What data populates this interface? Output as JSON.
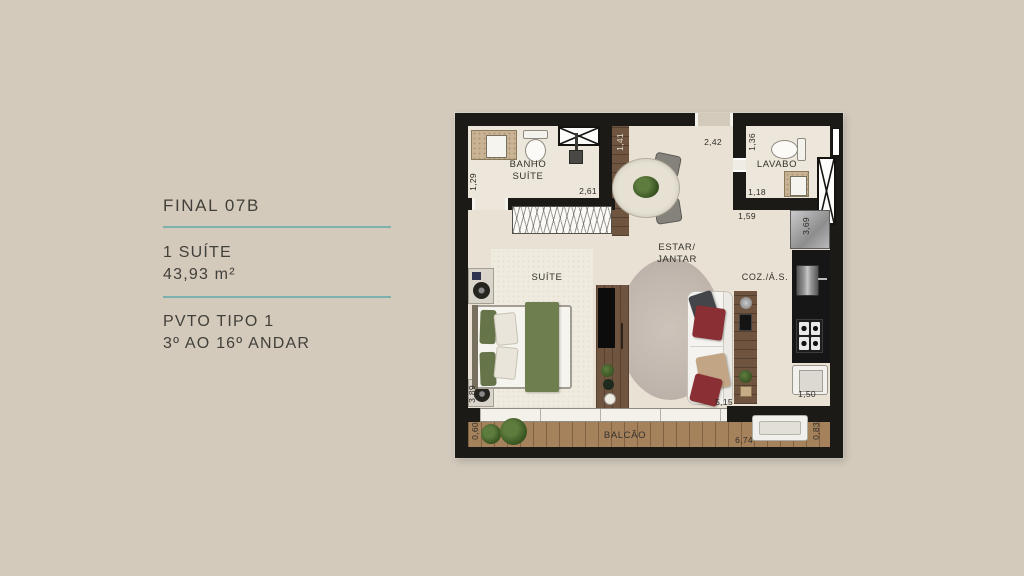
{
  "canvas": {
    "background": "#d3cabc"
  },
  "info_panel": {
    "title": "FINAL 07B",
    "unit_line1": "1 SUÍTE",
    "unit_line2": "43,93 m²",
    "pvto_line1": "PVTO TIPO 1",
    "pvto_line2": "3º AO 16º ANDAR",
    "divider_color": "#7db1ad",
    "text_color": "#42403a"
  },
  "plan": {
    "rooms": {
      "banho_line1": "BANHO",
      "banho_line2": "SUÍTE",
      "lavabo": "LAVABO",
      "estar_line1": "ESTAR/",
      "estar_line2": "JANTAR",
      "suite": "SUÍTE",
      "cozinha": "COZ./Á.S.",
      "balcao": "BALCÃO"
    },
    "dimensions": {
      "banho_width": "1,29",
      "banho_length": "2,61",
      "hall_depth": "1,41",
      "hall_width": "2,42",
      "lavabo_width": "1,36",
      "lavabo_length": "1,18",
      "lavabo_outer": "1,59",
      "cozinha_depth": "3,69",
      "estar_length": "5,15",
      "suite_width": "3,89",
      "balcao_depth": "0,60",
      "balcao_length": "6,74",
      "balcao_right": "0,83",
      "area_servico": "1,50"
    },
    "colors": {
      "wall": "#1b1a17",
      "floor": "#e9e2d4",
      "bath_floor": "#ece7da",
      "wood": "#6f5540",
      "deck": "#a5825c",
      "living_rug": "#c3b8af",
      "suite_rug": "#f0ebdf",
      "bed_green": "#6f7e4e",
      "pillow_red": "#8a2f33",
      "accent_teal": "#7db1ad"
    }
  }
}
